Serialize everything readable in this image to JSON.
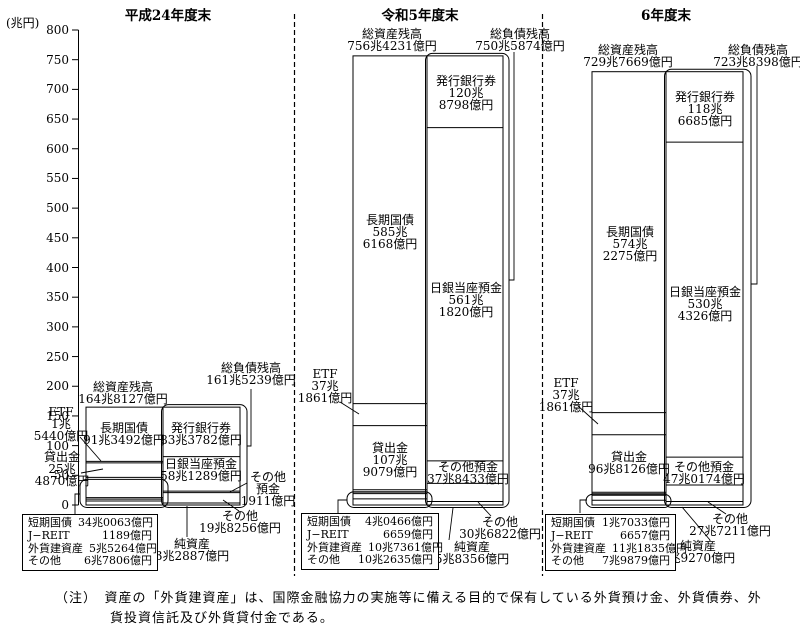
{
  "chart_data": {
    "type": "bar",
    "title": "日本銀行の資産・負債残高",
    "unit": "兆円",
    "y_axis": {
      "label": "(兆円)",
      "min": 0,
      "max": 800,
      "tick_step": 50
    },
    "periods": [
      {
        "title": "平成24年度末",
        "total_assets": {
          "name": "総資産残高",
          "value": 164.8127,
          "lines": [
            "総資産残高",
            "164兆8127億円"
          ]
        },
        "total_liabilities": {
          "name": "総負債残高",
          "value": 161.5239,
          "lines": [
            "総負債残高",
            "161兆5239億円"
          ]
        },
        "assets": [
          {
            "name": "長期国債",
            "value": 91.3492,
            "lines": [
              "長期国債",
              "91兆3492億円"
            ]
          },
          {
            "name": "ETF",
            "value": 1.544,
            "lines": [
              "ETF",
              "1兆",
              "5440億円"
            ]
          },
          {
            "name": "貸出金",
            "value": 25.487,
            "lines": [
              "貸出金",
              "25兆",
              "4870億円"
            ]
          },
          {
            "name": "短期国債",
            "value": 34.0063,
            "in_table": true
          },
          {
            "name": "J−REIT",
            "value": 0.1189,
            "in_table": true
          },
          {
            "name": "外貨建資産",
            "value": 5.5264,
            "in_table": true
          },
          {
            "name": "その他",
            "value": 6.7806,
            "in_table": true
          }
        ],
        "liabilities": [
          {
            "name": "発行銀行券",
            "value": 83.3782,
            "lines": [
              "発行銀行券",
              "83兆3782億円"
            ]
          },
          {
            "name": "日銀当座預金",
            "value": 58.1289,
            "lines": [
              "日銀当座預金",
              "58兆1289億円"
            ]
          },
          {
            "name": "その他預金",
            "value": 0.1911,
            "lines": [
              "その他",
              "預金",
              "1911億円"
            ]
          },
          {
            "name": "その他",
            "value": 19.8256,
            "lines": [
              "その他",
              "19兆8256億円"
            ]
          }
        ],
        "net_assets": {
          "name": "純資産",
          "value": 3.2887,
          "lines": [
            "純資産",
            "3兆2887億円"
          ]
        },
        "table": {
          "rows": [
            {
              "name": "短期国債",
              "value": "34兆0063億円"
            },
            {
              "name": "J−REIT",
              "value": "1189億円"
            },
            {
              "name": "外貨建資産",
              "value": "5兆5264億円"
            },
            {
              "name": "その他",
              "value": "6兆7806億円"
            }
          ]
        }
      },
      {
        "title": "令和5年度末",
        "total_assets": {
          "name": "総資産残高",
          "value": 756.4231,
          "lines": [
            "総資産残高",
            "756兆4231億円"
          ]
        },
        "total_liabilities": {
          "name": "総負債残高",
          "value": 750.5874,
          "lines": [
            "総負債残高",
            "750兆5874億円"
          ]
        },
        "assets": [
          {
            "name": "長期国債",
            "value": 585.6168,
            "lines": [
              "長期国債",
              "585兆",
              "6168億円"
            ]
          },
          {
            "name": "ETF",
            "value": 37.1861,
            "lines": [
              "ETF",
              "37兆",
              "1861億円"
            ]
          },
          {
            "name": "貸出金",
            "value": 107.9079,
            "lines": [
              "貸出金",
              "107兆",
              "9079億円"
            ]
          },
          {
            "name": "短期国債",
            "value": 4.0466,
            "in_table": true
          },
          {
            "name": "J−REIT",
            "value": 0.6659,
            "in_table": true
          },
          {
            "name": "外貨建資産",
            "value": 10.7361,
            "in_table": true
          },
          {
            "name": "その他",
            "value": 10.2635,
            "in_table": true
          }
        ],
        "liabilities": [
          {
            "name": "発行銀行券",
            "value": 120.8798,
            "lines": [
              "発行銀行券",
              "120兆",
              "8798億円"
            ]
          },
          {
            "name": "日銀当座預金",
            "value": 561.182,
            "lines": [
              "日銀当座預金",
              "561兆",
              "1820億円"
            ]
          },
          {
            "name": "その他預金",
            "value": 37.8433,
            "lines": [
              "その他預金",
              "37兆8433億円"
            ]
          },
          {
            "name": "その他",
            "value": 30.6822,
            "lines": [
              "その他",
              "30兆6822億円"
            ]
          }
        ],
        "net_assets": {
          "name": "純資産",
          "value": 5.8356,
          "lines": [
            "純資産",
            "5兆8356億円"
          ]
        },
        "table": {
          "rows": [
            {
              "name": "短期国債",
              "value": "4兆0466億円"
            },
            {
              "name": "J−REIT",
              "value": "6659億円"
            },
            {
              "name": "外貨建資産",
              "value": "10兆7361億円"
            },
            {
              "name": "その他",
              "value": "10兆2635億円"
            }
          ]
        }
      },
      {
        "title": "6年度末",
        "total_assets": {
          "name": "総資産残高",
          "value": 729.7669,
          "lines": [
            "総資産残高",
            "729兆7669億円"
          ]
        },
        "total_liabilities": {
          "name": "総負債残高",
          "value": 723.8398,
          "lines": [
            "総負債残高",
            "723兆8398億円"
          ]
        },
        "assets": [
          {
            "name": "長期国債",
            "value": 574.2275,
            "lines": [
              "長期国債",
              "574兆",
              "2275億円"
            ]
          },
          {
            "name": "ETF",
            "value": 37.1861,
            "lines": [
              "ETF",
              "37兆",
              "1861億円"
            ]
          },
          {
            "name": "貸出金",
            "value": 96.8126,
            "lines": [
              "貸出金",
              "96兆8126億円"
            ]
          },
          {
            "name": "短期国債",
            "value": 1.7033,
            "in_table": true
          },
          {
            "name": "J−REIT",
            "value": 0.6657,
            "in_table": true
          },
          {
            "name": "外貨建資産",
            "value": 11.1835,
            "in_table": true
          },
          {
            "name": "その他",
            "value": 7.9879,
            "in_table": true
          }
        ],
        "liabilities": [
          {
            "name": "発行銀行券",
            "value": 118.6685,
            "lines": [
              "発行銀行券",
              "118兆",
              "6685億円"
            ]
          },
          {
            "name": "日銀当座預金",
            "value": 530.4326,
            "lines": [
              "日銀当座預金",
              "530兆",
              "4326億円"
            ]
          },
          {
            "name": "その他預金",
            "value": 47.0174,
            "lines": [
              "その他預金",
              "47兆0174億円"
            ]
          },
          {
            "name": "その他",
            "value": 27.7211,
            "lines": [
              "その他",
              "27兆7211億円"
            ]
          }
        ],
        "net_assets": {
          "name": "純資産",
          "value": 5.927,
          "lines": [
            "純資産",
            "5兆9270億円"
          ]
        },
        "table": {
          "rows": [
            {
              "name": "短期国債",
              "value": "1兆7033億円"
            },
            {
              "name": "J−REIT",
              "value": "6657億円"
            },
            {
              "name": "外貨建資産",
              "value": "11兆1835億円"
            },
            {
              "name": "その他",
              "value": "7兆9879億円"
            }
          ]
        }
      }
    ]
  },
  "note": {
    "lines": [
      "（注）　資産の「外貨建資産」は、国際金融協力の実施等に備える目的で保有している外貨預け金、外貨債券、外",
      "貨投資信託及び外貨貸付金である。"
    ]
  }
}
